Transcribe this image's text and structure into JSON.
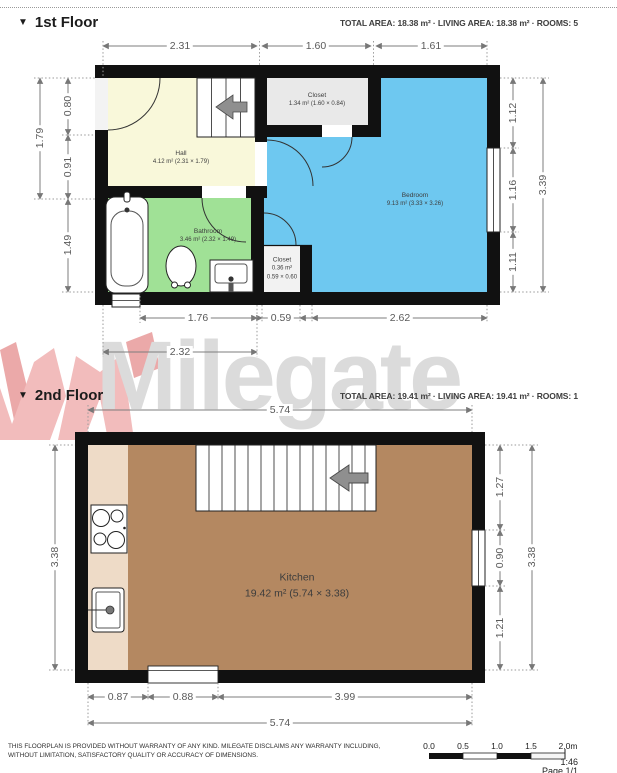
{
  "watermark": {
    "text": "Milegate"
  },
  "floor1": {
    "header": {
      "icon": "▼",
      "title": "1st Floor",
      "stats": "TOTAL AREA: 18.38 m² · LIVING AREA: 18.38 m² · ROOMS: 5"
    },
    "dims": {
      "top": [
        "2.31",
        "1.60",
        "1.61"
      ],
      "left_outer": "1.79",
      "left_inner": [
        "0.80",
        "0.91",
        "1.49"
      ],
      "right_inner": [
        "1.12",
        "1.16",
        "1.11"
      ],
      "right_outer": "3.39",
      "bottom_inner": [
        "1.76",
        "0.59",
        "2.62"
      ],
      "bottom_outer": "2.32"
    },
    "rooms": {
      "hall": {
        "name": "Hall",
        "area": "4.12 m² (2.31 × 1.79)"
      },
      "closet": {
        "name": "Closet",
        "area": "1.34 m² (1.60 × 0.84)"
      },
      "bedroom": {
        "name": "Bedroom",
        "area": "9.13 m² (3.33 × 3.26)"
      },
      "bathroom": {
        "name": "Bathroom",
        "area": "3.46 m² (2.32 × 1.49)"
      },
      "closet_small": {
        "name": "Closet",
        "area_line1": "0.36 m²",
        "area_line2": "0.59 × 0.60"
      }
    }
  },
  "floor2": {
    "header": {
      "icon": "▼",
      "title": "2nd Floor",
      "stats": "TOTAL AREA: 19.41 m² · LIVING AREA: 19.41 m² · ROOMS: 1"
    },
    "dims": {
      "top": "5.74",
      "left_outer": "3.38",
      "right_inner": [
        "1.27",
        "0.90",
        "1.21"
      ],
      "right_outer": "3.38",
      "bottom_inner": [
        "0.87",
        "0.88",
        "3.99"
      ],
      "bottom_outer": "5.74"
    },
    "rooms": {
      "kitchen": {
        "name": "Kitchen",
        "area": "19.42 m² (5.74 × 3.38)"
      }
    }
  },
  "footer": {
    "disclaimer_line1": "THIS FLOORPLAN IS PROVIDED WITHOUT WARRANTY OF ANY KIND. MILEGATE DISCLAIMS ANY WARRANTY INCLUDING,",
    "disclaimer_line2": "WITHOUT LIMITATION, SATISFACTORY QUALITY OR ACCURACY OF DIMENSIONS.",
    "scale_labels": [
      "0.0",
      "0.5",
      "1.0",
      "1.5",
      "2.0m"
    ],
    "scale_ratio": "1:46",
    "page": "Page 1/1"
  },
  "colors": {
    "wall": "#111111",
    "hall": "#f9f8da",
    "closet": "#e9e9e9",
    "bedroom": "#6ec8f0",
    "bathroom": "#a0e196",
    "kitchen": "#b48861",
    "counter": "#eedbc7",
    "watermark_text": "#dbdbdb",
    "watermark_logo": "#f2bcbc",
    "dim_line": "#7d7d7d"
  }
}
